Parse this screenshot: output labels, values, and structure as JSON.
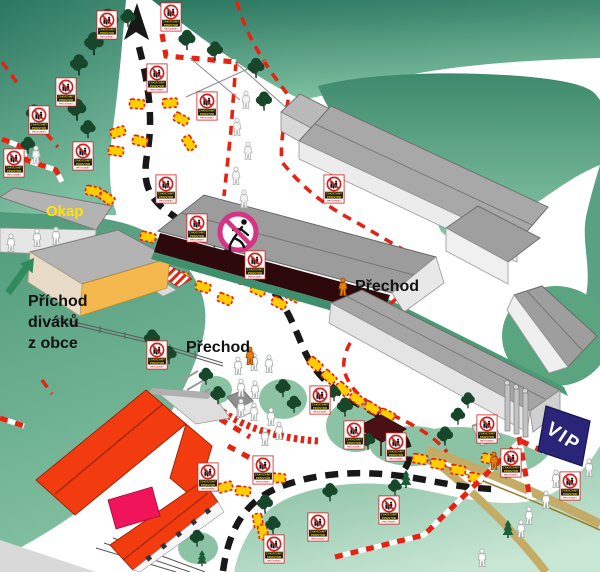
{
  "labels": {
    "okap": "Okap",
    "prichod_line1": "Příchod",
    "prichod_line2": "diváků",
    "prichod_line3": "z obce",
    "prechod_left": "Přechod",
    "prechod_right": "Přechod",
    "vip": "VIP"
  },
  "warning_sign": {
    "line1": "ZAKÁZANÝ",
    "line2": "PROSTOR",
    "line3": "PRO DIVÁKY"
  },
  "icons": {
    "no_spectators_sign": "red prohibition circle over spectator figures",
    "no_crossing_sign": "pink prohibition circle over running person",
    "route_arrow": "black arrow showing route direction",
    "spectator_arrow": "green arrow showing spectator arrival from village"
  },
  "colors": {
    "track_dash": "#181818",
    "barrier_red": "#e42313",
    "hay_bale_yellow": "#ffce00",
    "green_dark": "#2a7660",
    "green_light": "#8cc3a4",
    "building_grey": "#a8a8a8",
    "roof_red_orange": "#f23c10",
    "vip_navy": "#2a2578",
    "no_crossing_pink": "#d63384",
    "sign_text_yellow": "#ffd500",
    "label_yellow": "#ffe400",
    "path_khaki": "#c4ab66",
    "person_orange": "#e87d16"
  }
}
